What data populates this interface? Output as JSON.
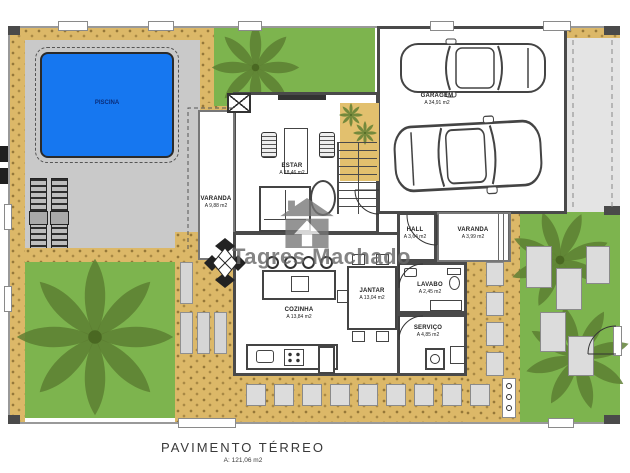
{
  "plan": {
    "title": "PAVIMENTO TÉRREO",
    "title_area": "A: 121,06 m2",
    "watermark": "Tagres Machado",
    "rooms": {
      "piscina": {
        "name": "PISCINA"
      },
      "varanda_piscina": {
        "name": "VARANDA",
        "area": "A 9,88 m2"
      },
      "estar": {
        "name": "ESTAR",
        "area": "A 18,46 m2"
      },
      "garagem": {
        "name": "GARAGEM",
        "area": "A 34,91 m2"
      },
      "hall": {
        "name": "HALL",
        "area": "A 3,64 m2"
      },
      "varanda_entrada": {
        "name": "VARANDA",
        "area": "A 3,99 m2"
      },
      "lavabo": {
        "name": "LAVABO",
        "area": "A 2,45 m2"
      },
      "servico": {
        "name": "SERVIÇO",
        "area": "A 4,85 m2"
      },
      "jantar": {
        "name": "JANTAR",
        "area": "A 13,04 m2"
      },
      "cozinha": {
        "name": "COZINHA",
        "area": "A 13,84 m2"
      }
    },
    "colors": {
      "grass": "#7db44e",
      "sand": "#dcb868",
      "pool_water": "#1677f0",
      "deck": "#c9c9c9",
      "wall": "#4a4a4a",
      "palm": "#5c7c31",
      "stone": "#dcdcdc",
      "watermark": "#777777"
    }
  }
}
